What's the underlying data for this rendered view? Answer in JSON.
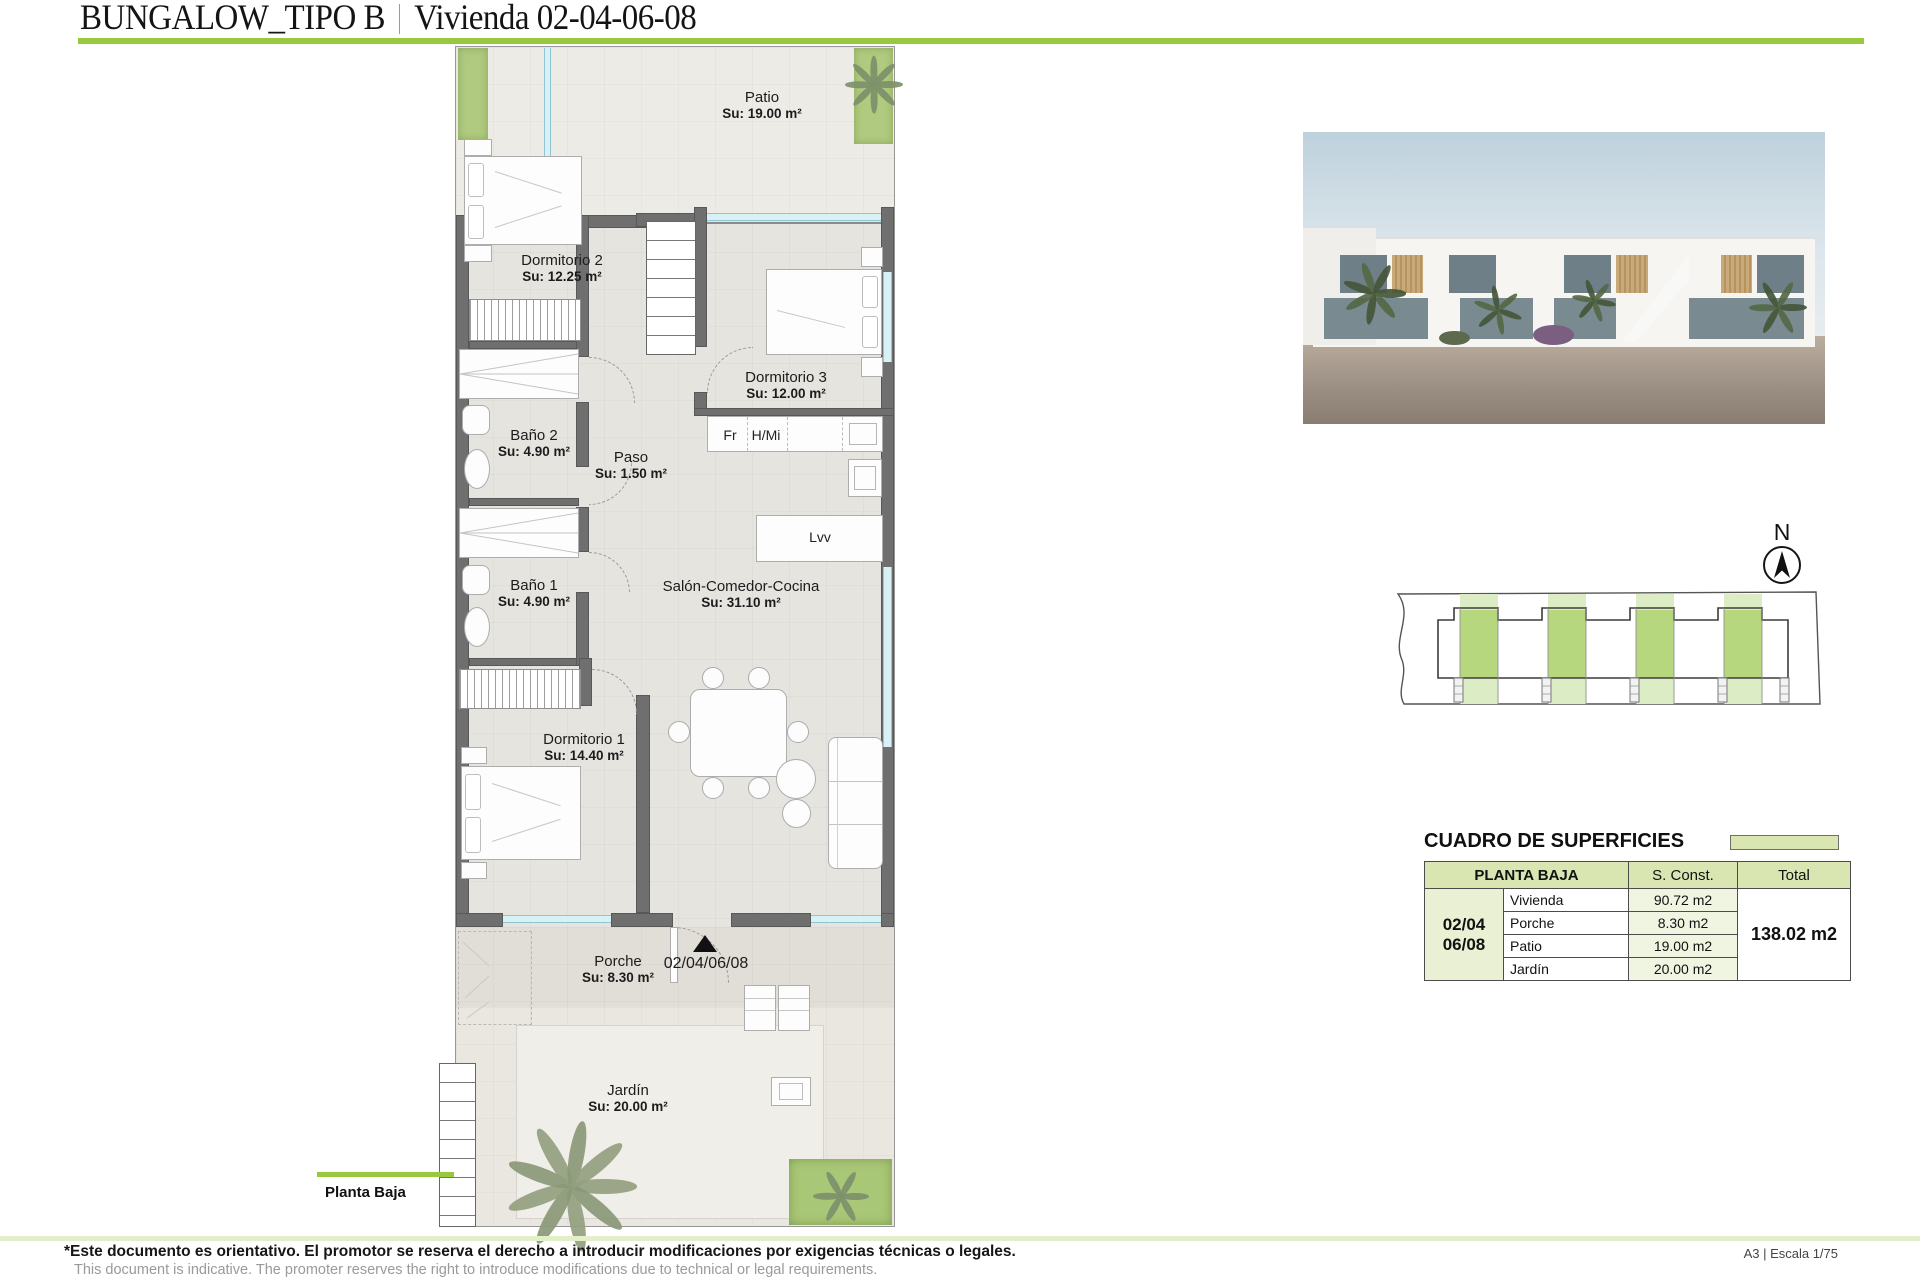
{
  "header": {
    "title_left": "BUNGALOW_TIPO B",
    "separator": "|",
    "title_right": "Vivienda 02-04-06-08"
  },
  "plan": {
    "rooms": {
      "patio": {
        "name": "Patio",
        "area": "Su: 19.00 m²"
      },
      "dormitorio2": {
        "name": "Dormitorio 2",
        "area": "Su: 12.25 m²"
      },
      "dormitorio3": {
        "name": "Dormitorio 3",
        "area": "Su: 12.00 m²"
      },
      "bano2": {
        "name": "Baño 2",
        "area": "Su: 4.90 m²"
      },
      "paso": {
        "name": "Paso",
        "area": "Su: 1.50 m²"
      },
      "bano1": {
        "name": "Baño 1",
        "area": "Su: 4.90 m²"
      },
      "salon": {
        "name": "Salón-Comedor-Cocina",
        "area": "Su: 31.10 m²"
      },
      "dormitorio1": {
        "name": "Dormitorio 1",
        "area": "Su: 14.40 m²"
      },
      "porche": {
        "name": "Porche",
        "area": "Su: 8.30 m²"
      },
      "jardin": {
        "name": "Jardín",
        "area": "Su: 20.00 m²"
      }
    },
    "kitchen": {
      "fridge": "Fr",
      "oven_micro": "H/Mi",
      "dishwasher": "Lvv"
    },
    "unit_marker": "02/04/06/08",
    "floor_label": "Planta Baja"
  },
  "compass": {
    "north_label": "N"
  },
  "surfaces": {
    "section_title": "CUADRO DE SUPERFICIES",
    "table": {
      "header": {
        "col1": "PLANTA BAJA",
        "col2": "S. Const.",
        "col3": "Total"
      },
      "unit_line1": "02/04",
      "unit_line2": "06/08",
      "rows": [
        {
          "label": "Vivienda",
          "value": "90.72 m2"
        },
        {
          "label": "Porche",
          "value": "8.30 m2"
        },
        {
          "label": "Patio",
          "value": "19.00 m2"
        },
        {
          "label": "Jardín",
          "value": "20.00 m2"
        }
      ],
      "total": "138.02 m2"
    }
  },
  "footer": {
    "disclaimer_es": "*Este documento es orientativo. El promotor se reserva el derecho a introducir modificaciones por exigencias técnicas o legales.",
    "disclaimer_en": "This document is indicative. The promoter reserves the right to introduce modifications due to technical or legal requirements.",
    "sheet_info": "A3 | Escala 1/75"
  },
  "colors": {
    "accent_green": "#98c93c",
    "wall_gray": "#6f6f6f",
    "window_cyan": "#d7f1f6",
    "table_header_green": "#d9e6b2",
    "siteplan_light_green": "#dcedc6",
    "siteplan_dark_green": "#b6d77e"
  }
}
